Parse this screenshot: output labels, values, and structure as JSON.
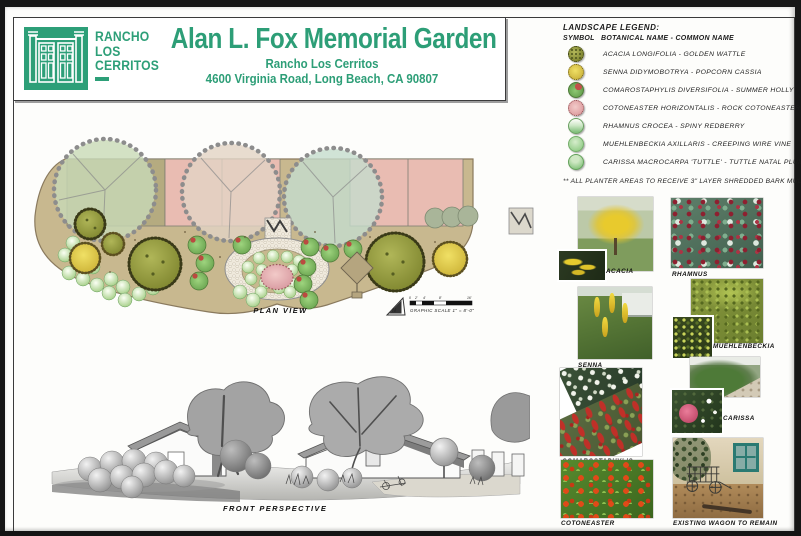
{
  "header": {
    "logo_lines": [
      "RANCHO",
      "LOS",
      "CERRITOS"
    ],
    "title": "Alan L. Fox Memorial Garden",
    "subtitle": "Rancho Los Cerritos",
    "address": "4600 Virginia Road, Long Beach, CA 90807"
  },
  "legend": {
    "title": "LANDSCAPE LEGEND:",
    "col_symbol": "SYMBOL",
    "col_name": "BOTANICAL NAME - COMMON NAME",
    "items": [
      {
        "name": "acacia",
        "label": "ACACIA LONGIFOLIA - GOLDEN WATTLE",
        "color": "#9aa23f"
      },
      {
        "name": "senna",
        "label": "SENNA DIDYMOBOTRYA - POPCORN CASSIA",
        "color": "#e3cf4a"
      },
      {
        "name": "comarostaphylis",
        "label": "COMAROSTAPHYLIS DIVERSIFOLIA - SUMMER HOLLY",
        "color": "#7cbf6b"
      },
      {
        "name": "cotoneaster",
        "label": "COTONEASTER HORIZONTALIS - ROCK COTONEASTER",
        "color": "#e2a6a9"
      },
      {
        "name": "rhamnus",
        "label": "RHAMNUS CROCEA - SPINY REDBERRY",
        "color": "#8fc98b"
      },
      {
        "name": "muehlenbeckia",
        "label": "MUEHLENBECKIA AXILLARIS - CREEPING WIRE VINE",
        "color": "#9fd49a"
      },
      {
        "name": "carissa",
        "label": "CARISSA MACROCARPA 'TUTTLE' - TUTTLE NATAL PLUM",
        "color": "#8cc988"
      }
    ],
    "note": "** ALL PLANTER AREAS TO RECEIVE 3\" LAYER SHREDDED BARK MULCH"
  },
  "plan": {
    "label": "PLAN VIEW",
    "north_label": "N",
    "scale_label": "GRAPHIC SCALE 1\" = 8'-0\"",
    "scale_ticks": [
      "0",
      "2'",
      "4'",
      "8'",
      "16'"
    ]
  },
  "perspective": {
    "label": "FRONT PERSPECTIVE"
  },
  "photos": [
    {
      "name": "acacia",
      "label": "ACACIA"
    },
    {
      "name": "rhamnus",
      "label": "RHAMNUS"
    },
    {
      "name": "senna",
      "label": "SENNA"
    },
    {
      "name": "muehlenbeckia",
      "label": "MUEHLENBECKIA"
    },
    {
      "name": "comarostaphylis",
      "label": "COMAROSTAPHYLIS"
    },
    {
      "name": "carissa",
      "label": "CARISSA"
    },
    {
      "name": "cotoneaster",
      "label": "COTONEASTER"
    },
    {
      "name": "wagon",
      "label": "EXISTING WAGON TO REMAIN"
    }
  ],
  "colors": {
    "brand_green": "#2d9f78",
    "bed_tan": "#c8b88f",
    "paving_pink": "#e9bcb2",
    "stone_path": "#efe9dc"
  }
}
